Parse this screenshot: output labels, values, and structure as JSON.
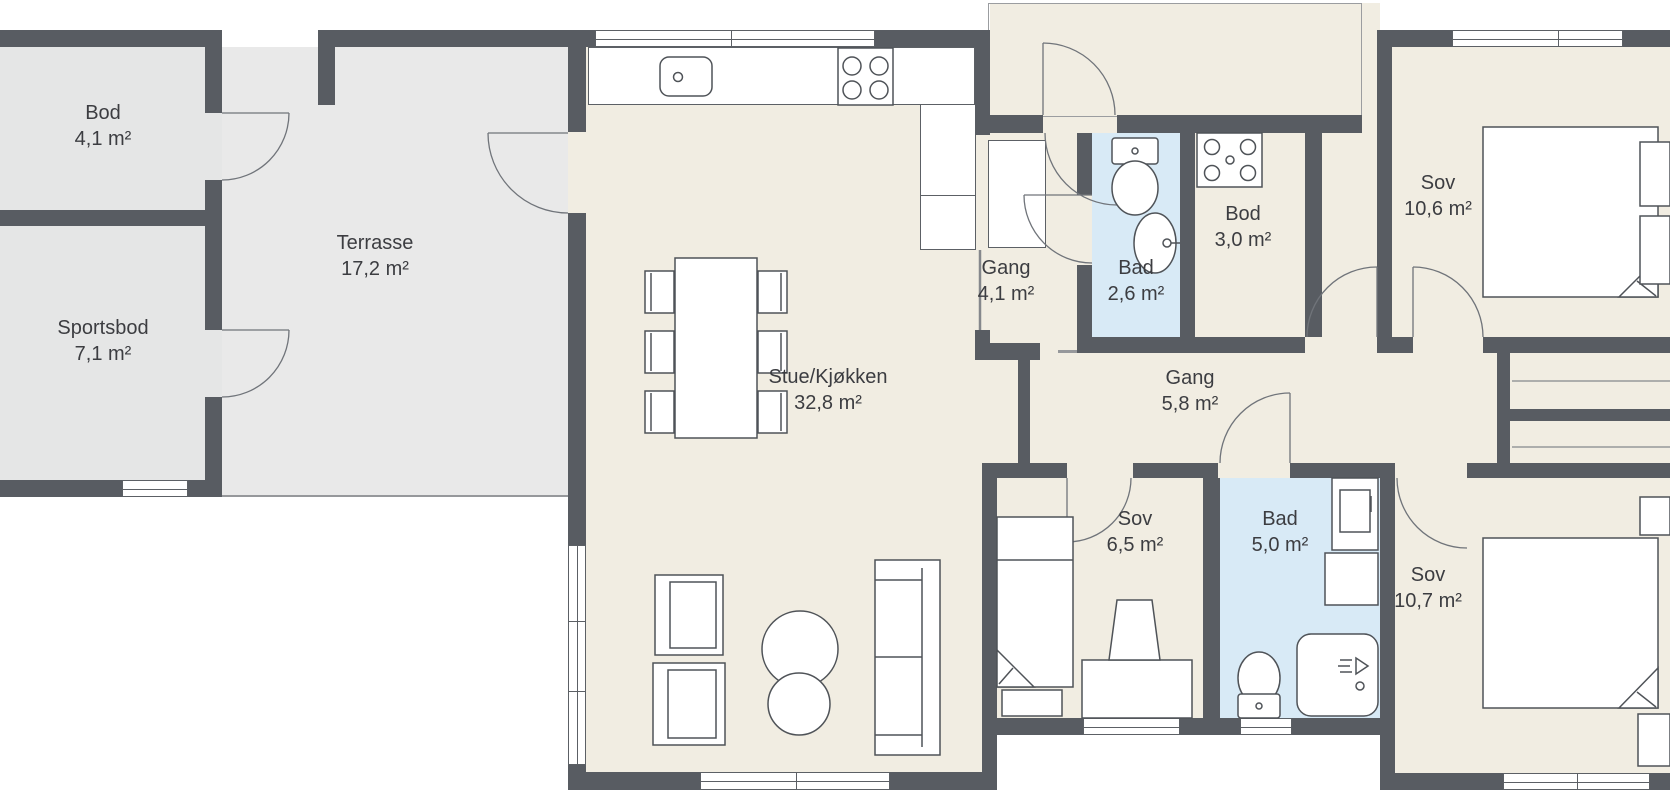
{
  "plan": {
    "title": "Floor plan",
    "rooms": {
      "bod_outbuilding": {
        "name": "Bod",
        "area": "4,1 m²"
      },
      "sportsbod": {
        "name": "Sportsbod",
        "area": "7,1 m²"
      },
      "terrasse": {
        "name": "Terrasse",
        "area": "17,2 m²"
      },
      "stue_kjokken": {
        "name": "Stue/Kjøkken",
        "area": "32,8 m²"
      },
      "gang_entre": {
        "name": "Gang",
        "area": "4,1 m²"
      },
      "bad_liten": {
        "name": "Bad",
        "area": "2,6 m²"
      },
      "bod_indre": {
        "name": "Bod",
        "area": "3,0 m²"
      },
      "sov_1": {
        "name": "Sov",
        "area": "10,6 m²"
      },
      "gang_indre": {
        "name": "Gang",
        "area": "5,8 m²"
      },
      "sov_2": {
        "name": "Sov",
        "area": "6,5 m²"
      },
      "bad_stor": {
        "name": "Bad",
        "area": "5,0 m²"
      },
      "sov_3": {
        "name": "Sov",
        "area": "10,7 m²"
      }
    },
    "colors": {
      "wall": "#585c62",
      "floor_inside": "#f1ede2",
      "floor_outside": "#e9e9e9",
      "floor_outbuilding": "#e5e6e6",
      "floor_bath": "#d8eaf6",
      "fixture_stroke": "#4f5358"
    }
  }
}
